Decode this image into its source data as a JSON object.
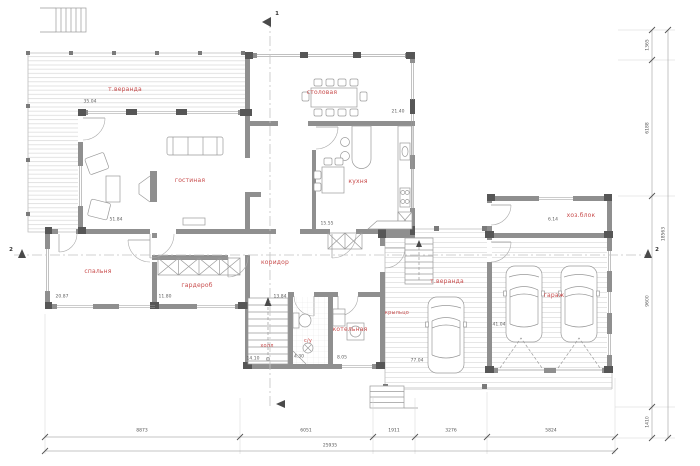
{
  "rooms": [
    {
      "id": "terrace",
      "label": "т.веранда",
      "area": "35.04"
    },
    {
      "id": "living",
      "label": "гостиная",
      "area": "51.84"
    },
    {
      "id": "dining",
      "label": "столовая",
      "area": "21.40"
    },
    {
      "id": "kitchen",
      "label": "кухня",
      "area": "15.55"
    },
    {
      "id": "bedroom",
      "label": "спальня",
      "area": "20.87"
    },
    {
      "id": "wardrobe",
      "label": "гардероб",
      "area": "11.80"
    },
    {
      "id": "corridor",
      "label": "коридор",
      "area": "13.84"
    },
    {
      "id": "hall",
      "label": "холл",
      "area": "14.10"
    },
    {
      "id": "wc",
      "label": "с/у",
      "area": "4.30"
    },
    {
      "id": "boiler",
      "label": "котельная",
      "area": "8.05"
    },
    {
      "id": "porch",
      "label": "крыльцо",
      "area": ""
    },
    {
      "id": "carport",
      "label": "т.веранда",
      "area": "77.04"
    },
    {
      "id": "garage",
      "label": "гараж",
      "area": "41.04"
    },
    {
      "id": "utility",
      "label": "хоз.блок",
      "area": "6.14"
    }
  ],
  "dimensions": {
    "bottom": [
      "8873",
      "6051",
      "1911",
      "3276",
      "5824"
    ],
    "bottom_total": "25935",
    "right": [
      "1365",
      "6188",
      "9600",
      "1410"
    ],
    "right_total": "18563"
  },
  "markers": {
    "section1": "1",
    "section2": "2"
  },
  "colors": {
    "wall": "#8f8f8f",
    "wall_dark": "#565656",
    "room_label": "#c84b4b",
    "hatch_line": "#dcdcdc",
    "dimension": "#777777"
  }
}
